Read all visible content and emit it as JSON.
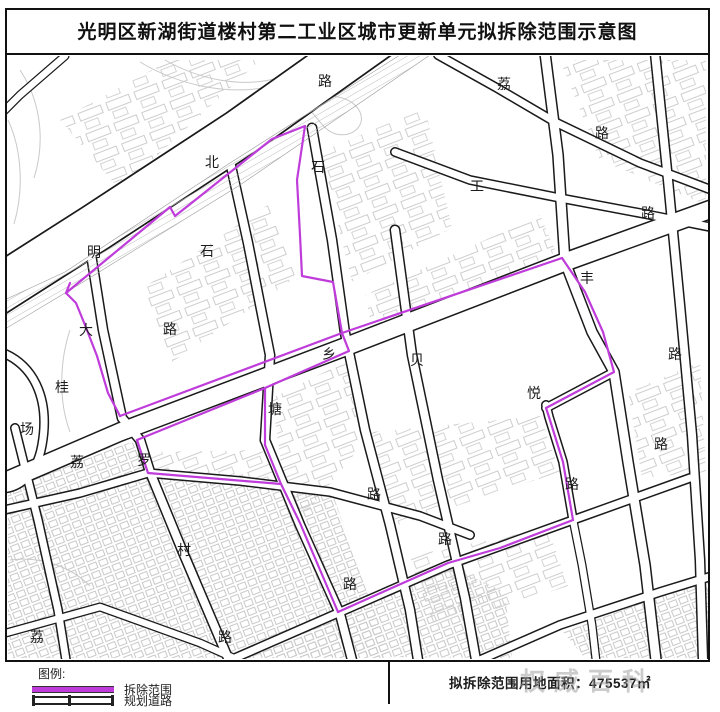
{
  "title": "光明区新湖街道楼村第二工业区城市更新单元拟拆除范围示意图",
  "colors": {
    "demolition_boundary": "#bf3cdb",
    "road_line": "#1a1a1a",
    "parcel_line": "#c9c9c9",
    "hatch_line": "#bdbdbd"
  },
  "legend": {
    "heading": "图例:",
    "items": [
      {
        "symbol": "demolition-boundary-line",
        "label": "拆除范围"
      },
      {
        "symbol": "planned-road",
        "label": "规划道路"
      }
    ]
  },
  "footer": {
    "area_note": "拟拆除范围用地面积：475537㎡"
  },
  "watermark": "权威百科",
  "map": {
    "labels": [
      {
        "text": "路",
        "x": 318,
        "y": 86
      },
      {
        "text": "荔",
        "x": 497,
        "y": 89
      },
      {
        "text": "路",
        "x": 595,
        "y": 138
      },
      {
        "text": "北",
        "x": 205,
        "y": 167
      },
      {
        "text": "石",
        "x": 311,
        "y": 172
      },
      {
        "text": "工",
        "x": 470,
        "y": 191
      },
      {
        "text": "路",
        "x": 641,
        "y": 218
      },
      {
        "text": "明",
        "x": 87,
        "y": 257
      },
      {
        "text": "石",
        "x": 200,
        "y": 256
      },
      {
        "text": "丰",
        "x": 580,
        "y": 283
      },
      {
        "text": "大",
        "x": 79,
        "y": 335
      },
      {
        "text": "路",
        "x": 163,
        "y": 334
      },
      {
        "text": "乡",
        "x": 322,
        "y": 359
      },
      {
        "text": "贝",
        "x": 410,
        "y": 365
      },
      {
        "text": "路",
        "x": 668,
        "y": 359
      },
      {
        "text": "桂",
        "x": 55,
        "y": 392
      },
      {
        "text": "悦",
        "x": 527,
        "y": 398
      },
      {
        "text": "塘",
        "x": 268,
        "y": 414
      },
      {
        "text": "场",
        "x": 20,
        "y": 434
      },
      {
        "text": "路",
        "x": 654,
        "y": 449
      },
      {
        "text": "荔",
        "x": 70,
        "y": 467
      },
      {
        "text": "罗",
        "x": 137,
        "y": 465
      },
      {
        "text": "路",
        "x": 565,
        "y": 489
      },
      {
        "text": "路",
        "x": 367,
        "y": 499
      },
      {
        "text": "路",
        "x": 438,
        "y": 544
      },
      {
        "text": "村",
        "x": 177,
        "y": 555
      },
      {
        "text": "路",
        "x": 343,
        "y": 589
      },
      {
        "text": "荔",
        "x": 30,
        "y": 642
      },
      {
        "text": "路",
        "x": 218,
        "y": 642
      }
    ]
  }
}
